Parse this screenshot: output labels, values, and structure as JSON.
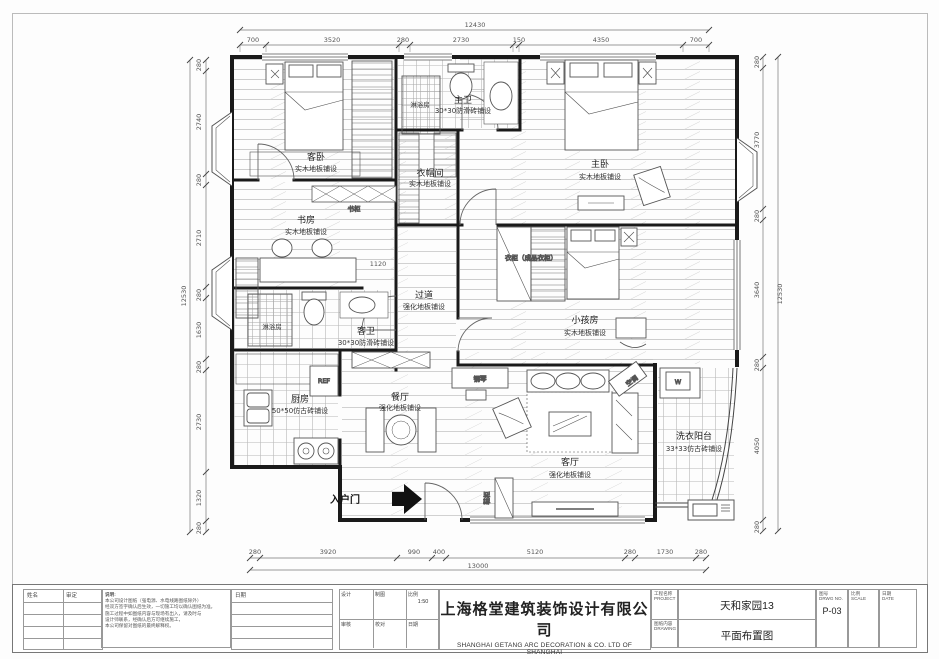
{
  "dims": {
    "top": {
      "total": "12430",
      "segments": [
        "700",
        "3520",
        "280",
        "2730",
        "150",
        "4350",
        "700"
      ]
    },
    "bottom": {
      "total": "13000",
      "segments": [
        "280",
        "3920",
        "990",
        "400",
        "5120",
        "280",
        "1730",
        "280"
      ]
    },
    "left": {
      "total": "12530",
      "segments": [
        "280",
        "2740",
        "280",
        "2710",
        "280",
        "1630",
        "280",
        "2730",
        "1320",
        "280"
      ]
    },
    "right": {
      "total": "12530",
      "segments": [
        "280",
        "3770",
        "280",
        "3640",
        "280",
        "4050",
        "280"
      ]
    },
    "hall_small": "1120"
  },
  "rooms": {
    "guest_bedroom": {
      "name": "客卧",
      "floor": "实木地板铺设"
    },
    "master_bath": {
      "name": "主卫",
      "floor": "30*30防滑砖铺设"
    },
    "master_bedroom": {
      "name": "主卧",
      "floor": "实木地板铺设"
    },
    "cloakroom": {
      "name": "衣帽间",
      "floor": "实木地板铺设"
    },
    "study": {
      "name": "书房",
      "floor": "实木地板铺设"
    },
    "guest_bath": {
      "name": "客卫",
      "floor": "30*30防滑砖铺设"
    },
    "hallway": {
      "name": "过道",
      "floor": "强化地板铺设"
    },
    "kids_room": {
      "name": "小孩房",
      "floor": "实木地板铺设"
    },
    "kitchen": {
      "name": "厨房",
      "floor": "50*50仿古砖铺设"
    },
    "dining": {
      "name": "餐厅",
      "floor": "强化地板铺设"
    },
    "living": {
      "name": "客厅",
      "floor": "强化地板铺设"
    },
    "laundry": {
      "name": "洗衣阳台",
      "floor": "33*33仿古砖铺设"
    }
  },
  "labels": {
    "shower": "淋浴房",
    "bookcase": "书柜",
    "wardrobe": "衣柜（成品衣柜）",
    "piano": "钢琴",
    "ac": "空调",
    "shoe_cabinet": "鞋柜",
    "entry_door": "入户门",
    "fridge": "REF",
    "washer": "W"
  },
  "titleblock": {
    "company_cn": "上海格堂建筑装饰设计有限公司",
    "company_en": "SHANGHAI GETANG ARC DECORATION  &  CO. LTD OF SHANGHAI",
    "project_label": "工程名称",
    "project_label_en": "PROJECT",
    "project_value": "天和家园13",
    "drawing_label": "图纸内容",
    "drawing_label_en": "DRAWING",
    "drawing_value": "平面布置图",
    "number_label": "图号",
    "number_label_en": "DRWG NO.",
    "number_value": "P-03",
    "scale_label": "比例",
    "scale_label_en": "SCALE",
    "date_label": "日期",
    "date_label_en": "DATE",
    "name_label": "姓名",
    "approve_label": "审定",
    "date_col_label": "日期",
    "fields": [
      {
        "label": "设计",
        "value": ""
      },
      {
        "label": "制图",
        "value": ""
      },
      {
        "label": "比例",
        "value": "1:50"
      },
      {
        "label": "审核",
        "value": ""
      },
      {
        "label": "校对",
        "value": ""
      },
      {
        "label": "日期",
        "value": ""
      }
    ],
    "notes_title": "说明:",
    "notes_lines": [
      "本公司设计图纸（强电源、水电线路图纸除外）",
      "经双方签字确认后生效，一切施工均以确认图纸为准。",
      "施工过程中如图纸内容与现场有出入，请及时与",
      "设计师联系，经确认后方可继续施工，",
      "本公司保留对图纸的最终解释权。"
    ]
  }
}
